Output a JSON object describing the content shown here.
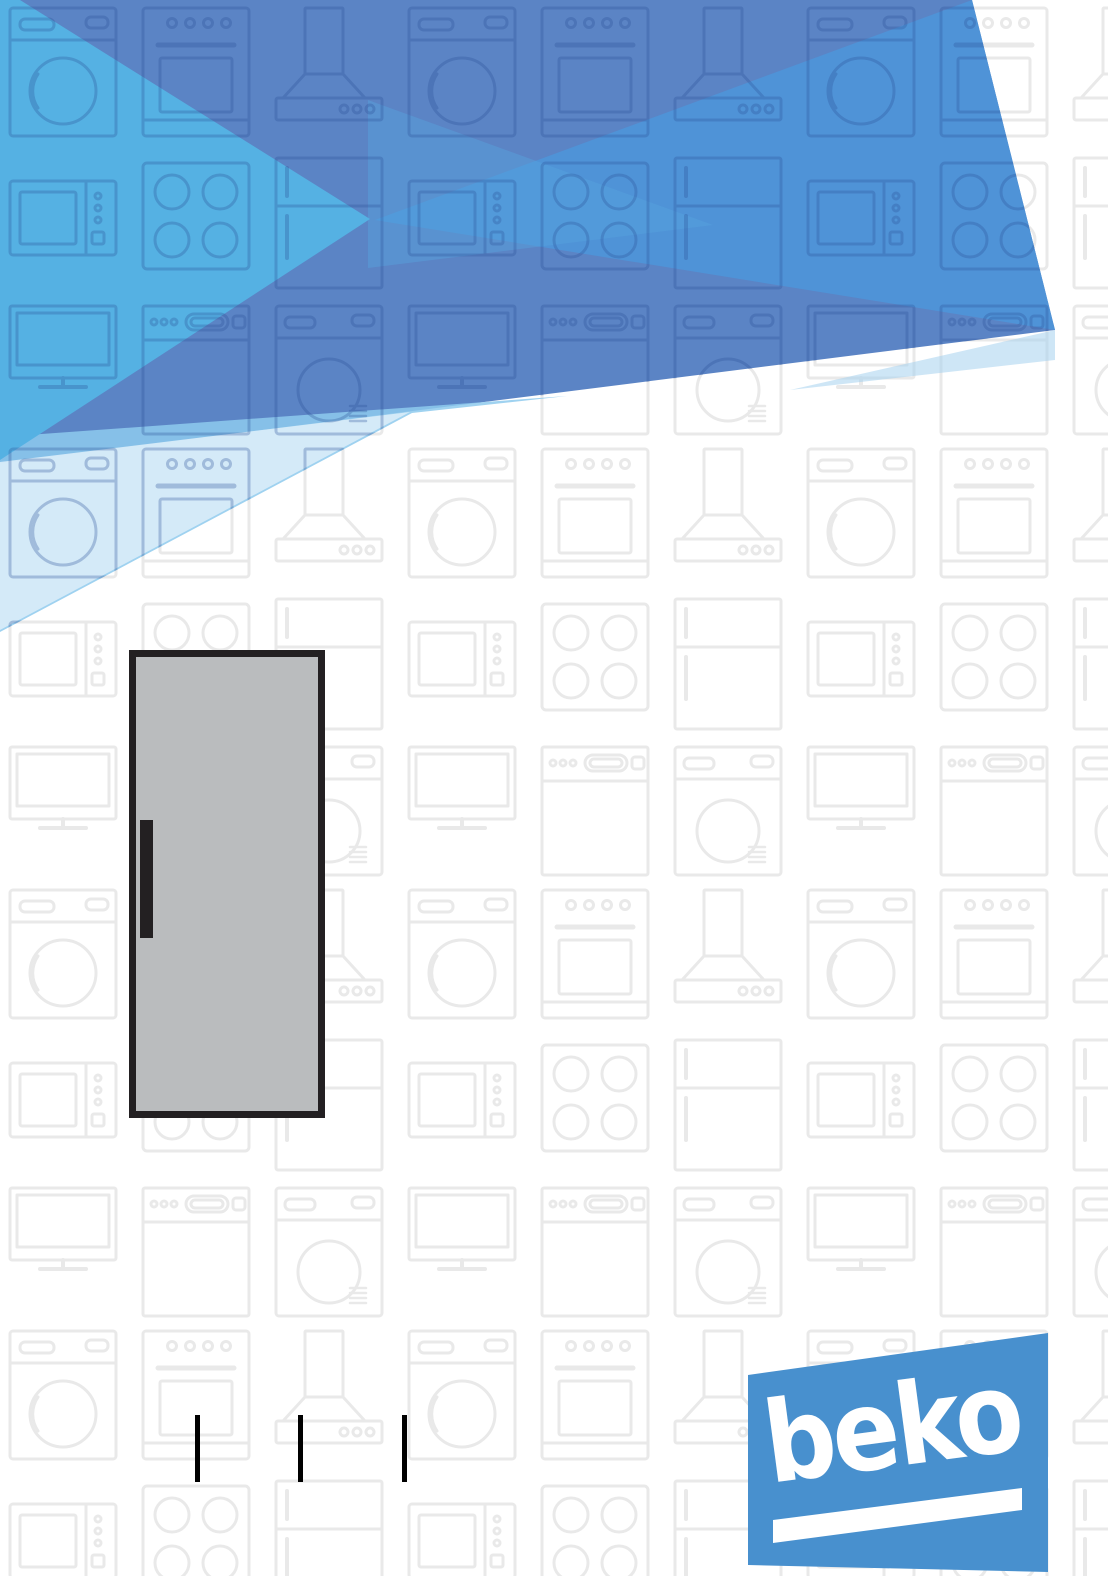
{
  "page": {
    "type": "appliance-user-manual-cover",
    "width_px": 1108,
    "height_px": 1576,
    "background_color": "#ffffff"
  },
  "brand": {
    "logo_text": "beko",
    "logo_blue": "#4890ce",
    "logo_text_color": "#ffffff"
  },
  "header_art": {
    "description": "banner of overlapping translucent blue triangles",
    "colors": {
      "base": "#5b84c5",
      "bright": "#4f93d7",
      "cross": "#57a3de",
      "light": "#8ecaed",
      "pale": "#d8ecf8",
      "tail": "#a5d2ee",
      "cyan": "#55b1e3"
    }
  },
  "illustration": {
    "name": "single-door-refrigerator",
    "door_color": "#babcbe",
    "outline_color": "#232022",
    "handle_color": "#232022"
  },
  "separator_bars": {
    "count": 3,
    "color": "#000000"
  },
  "background_pattern": {
    "name": "appliance-outline-pattern",
    "stroke_color": "#e9e9e9",
    "header_overlay_stroke_color": "#2a4f96",
    "appliances": [
      "washing-machine",
      "oven",
      "cooker-hood",
      "microwave",
      "hob",
      "refrigerator",
      "tv",
      "dishwasher",
      "tumble-dryer"
    ]
  }
}
